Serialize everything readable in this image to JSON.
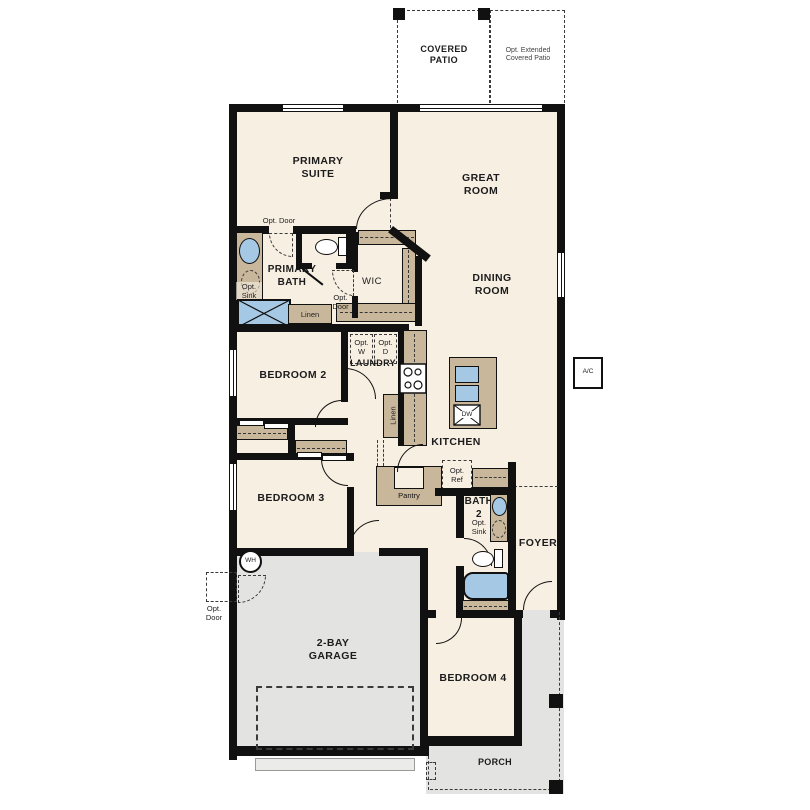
{
  "rooms": {
    "covered_patio": "COVERED PATIO",
    "opt_extended_patio": "Opt. Extended Covered Patio",
    "primary_suite": "PRIMARY SUITE",
    "great_room": "GREAT ROOM",
    "dining_room": "DINING ROOM",
    "primary_bath": "PRIMARY BATH",
    "wic": "WIC",
    "bedroom_2": "BEDROOM 2",
    "laundry": "LAUNDRY",
    "kitchen": "KITCHEN",
    "bedroom_3": "BEDROOM 3",
    "pantry": "Pantry",
    "bath_2": "BATH 2",
    "foyer": "FOYER",
    "garage": "2-BAY GARAGE",
    "bedroom_4": "BEDROOM 4",
    "porch": "PORCH"
  },
  "labels": {
    "opt_door": "Opt. Door",
    "opt_sink": "Opt. Sink",
    "opt_w": "Opt. W",
    "opt_d": "Opt. D",
    "opt_ref": "Opt. Ref",
    "linen": "Linen",
    "dw": "DW",
    "wh": "WH",
    "ac": "A/C"
  },
  "colors": {
    "interior": "#f7efe2",
    "outdoor": "#e3e3e1",
    "wall": "#111111",
    "cabinet": "#c9b79b",
    "fixture": "#a5c9e5"
  }
}
